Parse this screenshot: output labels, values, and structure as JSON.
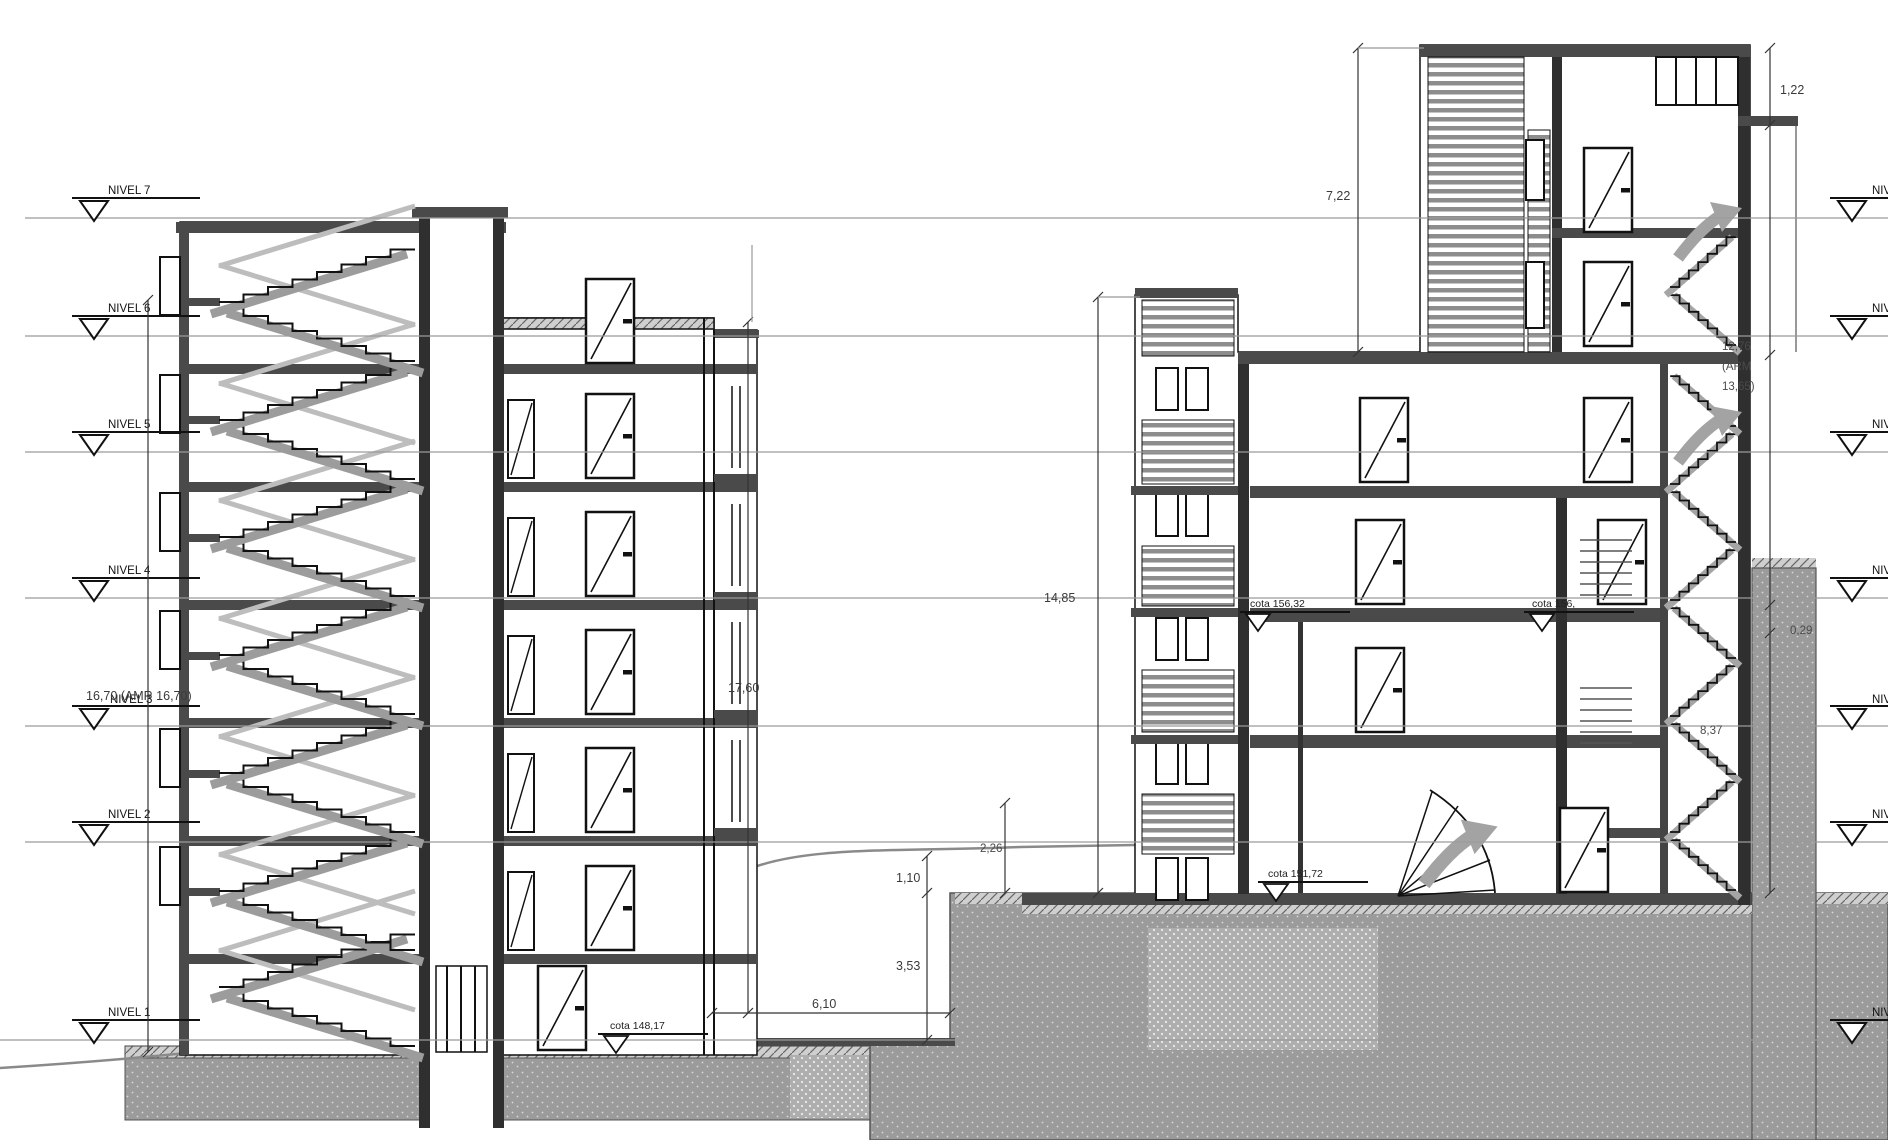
{
  "drawing_kind": "building-cross-section",
  "levels": [
    {
      "label": "NIVEL 7"
    },
    {
      "label": "NIVEL 6"
    },
    {
      "label": "NIVEL 5"
    },
    {
      "label": "NIVEL 4"
    },
    {
      "label": "NIVEL 3"
    },
    {
      "label": "NIVEL 2"
    },
    {
      "label": "NIVEL 1"
    }
  ],
  "dimensions": {
    "left_total": "16,70 (AMR 16,70)",
    "left_height": "17,60",
    "gap_v1": "1,10",
    "gap_v2": "3,53",
    "gap_h": "6,10",
    "gap_v3": "2,26",
    "right_block": "14,85",
    "tower": "7,22",
    "parapet": "1,22",
    "arm_1": "12,76",
    "arm_2": "(ARM",
    "arm_3": "13,65)",
    "step": "0,29",
    "slope": "8,37"
  },
  "cotas": {
    "entry": "cota 148,17",
    "mid_left": "cota 156,32",
    "mid_right": "cota 156,",
    "ground_right": "cota 151,72"
  },
  "colors": {
    "line": "#111111",
    "slab": "#4a4a4a",
    "wall_dark": "#2f2f2f",
    "level_line": "#9a9a9a",
    "terrain": "#8a8a8a",
    "ground_fill": "#9b9b9b",
    "stair_grey": "#9c9c9c",
    "rail_grey": "#bdbdbd",
    "arrow_grey": "#a3a3a3"
  }
}
